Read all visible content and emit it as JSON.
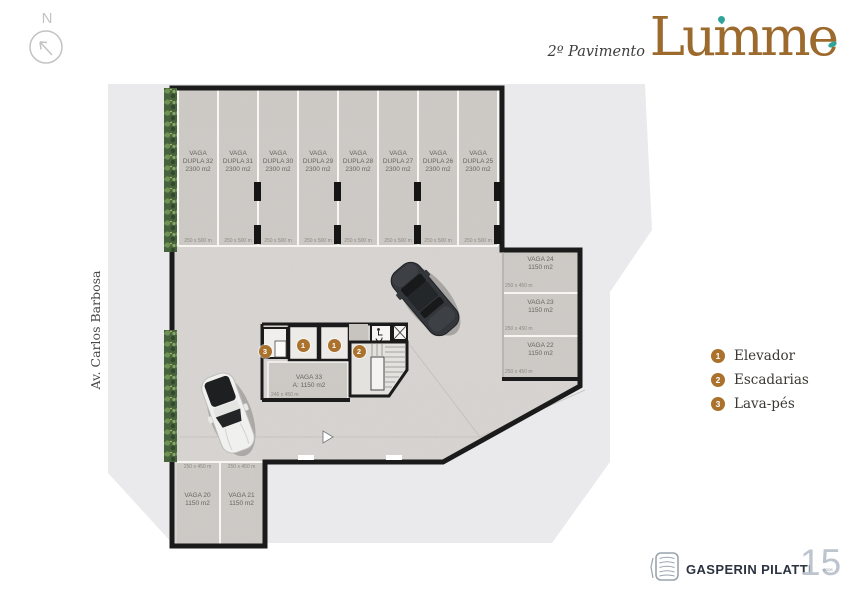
{
  "header": {
    "floor_label": "2º Pavimento",
    "brand": "Lumme"
  },
  "north": {
    "label": "N"
  },
  "street": {
    "name": "Av. Carlos Barbosa"
  },
  "plan": {
    "top_stalls": [
      {
        "line1": "VAGA",
        "line2": "DUPLA 32",
        "area": "2300 m2",
        "dim": "250 x 500 m"
      },
      {
        "line1": "VAGA",
        "line2": "DUPLA 31",
        "area": "2300 m2",
        "dim": "250 x 500 m"
      },
      {
        "line1": "VAGA",
        "line2": "DUPLA 30",
        "area": "2300 m2",
        "dim": "250 x 500 m"
      },
      {
        "line1": "VAGA",
        "line2": "DUPLA 29",
        "area": "2300 m2",
        "dim": "250 x 500 m"
      },
      {
        "line1": "VAGA",
        "line2": "DUPLA 28",
        "area": "2300 m2",
        "dim": "250 x 500 m"
      },
      {
        "line1": "VAGA",
        "line2": "DUPLA 27",
        "area": "2300 m2",
        "dim": "250 x 500 m"
      },
      {
        "line1": "VAGA",
        "line2": "DUPLA 26",
        "area": "2300 m2",
        "dim": "250 x 500 m"
      },
      {
        "line1": "VAGA",
        "line2": "DUPLA 25",
        "area": "2300 m2",
        "dim": "250 x 500 m"
      }
    ],
    "right_stalls": [
      {
        "name": "VAGA 24",
        "area": "1150 m2",
        "dim": "250 x 450 m"
      },
      {
        "name": "VAGA 23",
        "area": "1150 m2",
        "dim": "250 x 450 m"
      },
      {
        "name": "VAGA 22",
        "area": "1150 m2",
        "dim": "250 x 450 m"
      }
    ],
    "bottom_stalls": [
      {
        "name": "VAGA 20",
        "area": "1150 m2",
        "dim": "250 x 450 m"
      },
      {
        "name": "VAGA 21",
        "area": "1150 m2",
        "dim": "250 x 450 m"
      }
    ],
    "center_stall": {
      "name": "VAGA 33",
      "area": "A: 1150 m2",
      "dim": "246 x 450 m"
    },
    "markers": [
      {
        "num": "1"
      },
      {
        "num": "1"
      },
      {
        "num": "2"
      },
      {
        "num": "3"
      }
    ]
  },
  "legend": {
    "items": [
      {
        "num": "1",
        "label": "Elevador"
      },
      {
        "num": "2",
        "label": "Escadarias"
      },
      {
        "num": "3",
        "label": "Lava-pés"
      }
    ]
  },
  "footer": {
    "company": "GASPERIN PILATTI",
    "years_number": "15",
    "years_label": "anos"
  },
  "colors": {
    "accent_gold": "#ab722d",
    "brand_brown": "#9c6a2d",
    "teal": "#2fa49b",
    "wall": "#1b1b1b"
  }
}
